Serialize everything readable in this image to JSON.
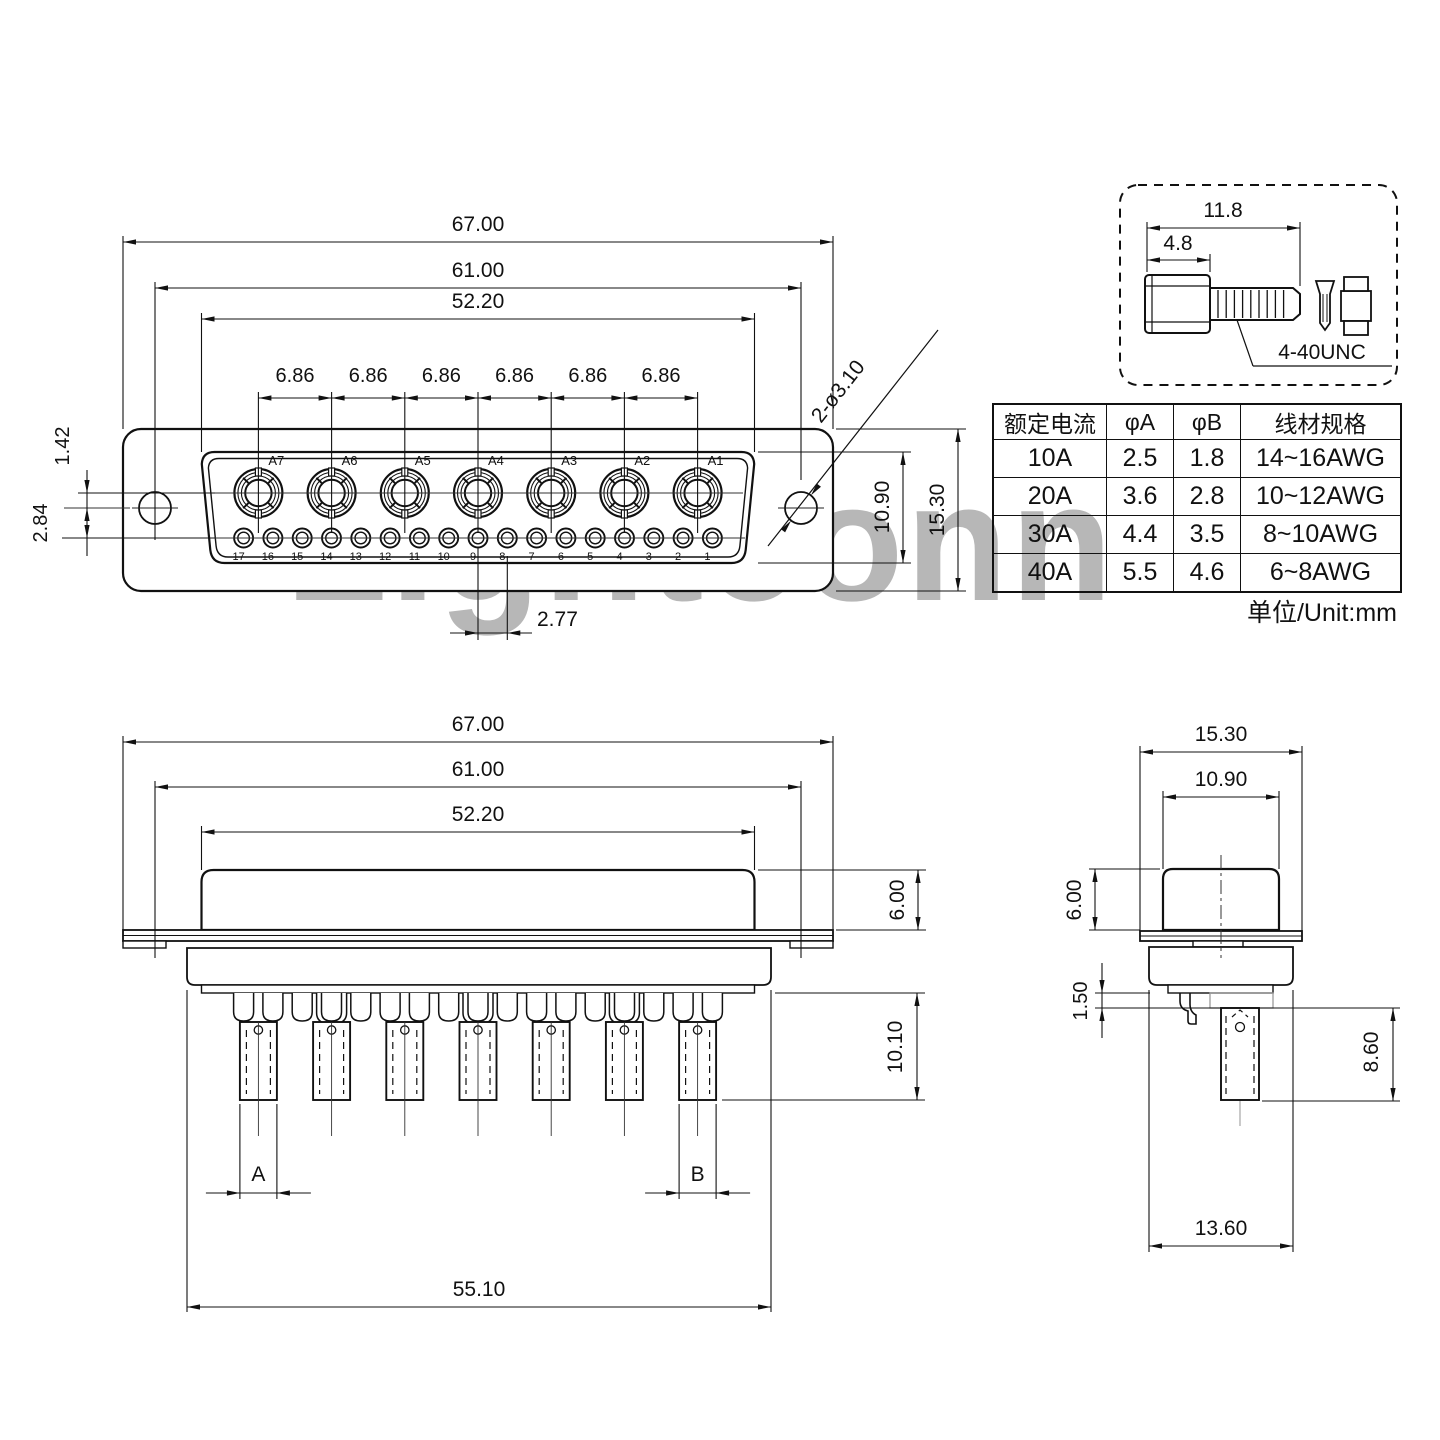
{
  "watermark": "Lightconn",
  "units_label": "单位/Unit:mm",
  "front_view": {
    "dims": {
      "width_outer": "67.00",
      "width_holes": "61.00",
      "width_shell": "52.20",
      "pitch_coax": "6.86",
      "offset_row_a": "1.42",
      "offset_row_b": "2.84",
      "pitch_small": "2.77",
      "shell_height": "10.90",
      "flange_height": "15.30",
      "mount_hole_callout": "2-ø3.10"
    },
    "coax_labels": [
      "A7",
      "A6",
      "A5",
      "A4",
      "A3",
      "A2",
      "A1"
    ],
    "pin_labels": [
      "17",
      "16",
      "15",
      "14",
      "13",
      "12",
      "11",
      "10",
      "9",
      "8",
      "7",
      "6",
      "5",
      "4",
      "3",
      "2",
      "1"
    ]
  },
  "screw_detail": {
    "length_total": "11.8",
    "length_head": "4.8",
    "thread": "4-40UNC"
  },
  "spec_table": {
    "headers": [
      "额定电流",
      "φA",
      "φB",
      "线材规格"
    ],
    "rows": [
      [
        "10A",
        "2.5",
        "1.8",
        "14~16AWG"
      ],
      [
        "20A",
        "3.6",
        "2.8",
        "10~12AWG"
      ],
      [
        "30A",
        "4.4",
        "3.5",
        "8~10AWG"
      ],
      [
        "40A",
        "5.5",
        "4.6",
        "6~8AWG"
      ]
    ]
  },
  "bottom_view": {
    "dims": {
      "width_outer": "67.00",
      "width_holes": "61.00",
      "width_shell": "52.20",
      "cup_a": "A",
      "cup_b": "B",
      "body_width": "55.10",
      "shell_height": "6.00",
      "pin_length": "10.10"
    }
  },
  "side_view": {
    "dims": {
      "flange_width": "15.30",
      "shell_width": "10.90",
      "shell_height": "6.00",
      "standoff": "1.50",
      "cup_length": "8.60",
      "body_width": "13.60"
    }
  }
}
